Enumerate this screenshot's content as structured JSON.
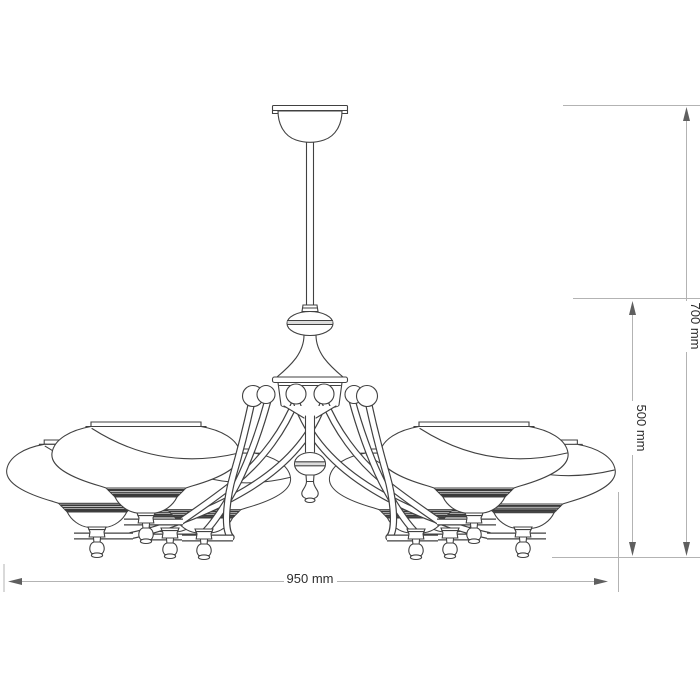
{
  "title": "chandelier-dimension-drawing",
  "dimensions": {
    "total_height": {
      "label": "700 mm"
    },
    "body_height": {
      "label": "500 mm"
    },
    "width": {
      "label": "950 mm"
    }
  },
  "colors": {
    "background": "#ffffff",
    "drawing_line": "#414141",
    "dimension_line": "#b3b3b3",
    "arrow": "#5f5f5f",
    "label_text": "#2e2e2e",
    "band_shade": "#e8e8e8"
  }
}
